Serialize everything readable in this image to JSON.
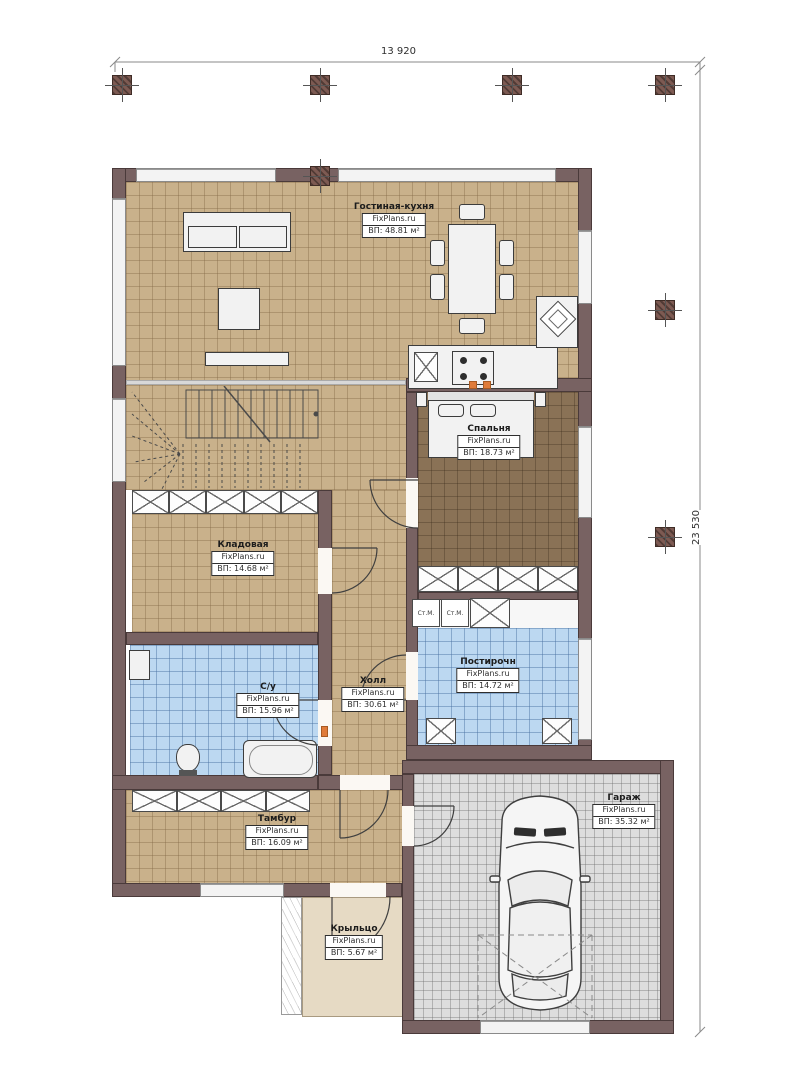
{
  "plan": {
    "dimensions": {
      "top": "13 920",
      "right": "23 530"
    },
    "rooms": [
      {
        "name": "Гостиная-кухня",
        "brand": "FixPlans.ru",
        "area": "ВП: 48.81 м²"
      },
      {
        "name": "Спальня",
        "brand": "FixPlans.ru",
        "area": "ВП: 18.73 м²"
      },
      {
        "name": "Кладовая",
        "brand": "FixPlans.ru",
        "area": "ВП: 14.68 м²"
      },
      {
        "name": "С/у",
        "brand": "FixPlans.ru",
        "area": "ВП: 15.96 м²"
      },
      {
        "name": "Холл",
        "brand": "FixPlans.ru",
        "area": "ВП: 30.61 м²"
      },
      {
        "name": "Постирочн",
        "brand": "FixPlans.ru",
        "area": "ВП: 14.72 м²"
      },
      {
        "name": "Тамбур",
        "brand": "FixPlans.ru",
        "area": "ВП: 16.09 м²"
      },
      {
        "name": "Крыльцо",
        "brand": "FixPlans.ru",
        "area": "ВП: 5.67 м²"
      },
      {
        "name": "Гараж",
        "brand": "FixPlans.ru",
        "area": "ВП: 35.32 м²"
      }
    ],
    "appliances": {
      "washer_label": "Ст.М."
    },
    "colors": {
      "wall": "#786262",
      "floor_living": "#c9b18b",
      "floor_bedroom": "#8a7256",
      "floor_wet": "#bcd8f1",
      "floor_garage": "#dddddd",
      "floor_porch": "#e6dac4",
      "marker_orange": "#e07b39",
      "column": "#7d5a52"
    }
  }
}
